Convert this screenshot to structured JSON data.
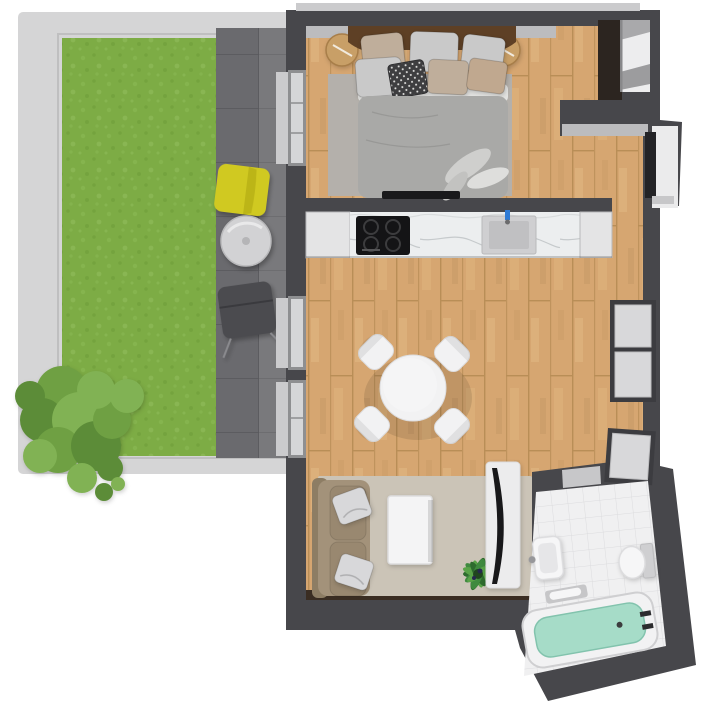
{
  "canvas": {
    "width": 716,
    "height": 720
  },
  "scene_type": "apartment-3d-floor-plan-top-view",
  "legend": {
    "outdoor": [
      "terrace-frame",
      "lawn",
      "patio-tiles",
      "bush",
      "yellow-lounge-chair",
      "patio-table",
      "dark-patio-chair"
    ],
    "bedroom": [
      "double-bed",
      "headboard",
      "pillows",
      "nightstand-left",
      "nightstand-right",
      "bedroom-rug",
      "wall-tv-bar"
    ],
    "kitchen": [
      "kitchen-counter",
      "cooktop",
      "kitchen-sink",
      "cabinet-left",
      "cabinet-right"
    ],
    "living_room": [
      "dining-table",
      "dining-chairs",
      "sofa",
      "sofa-pillows",
      "coffee-table",
      "living-rug",
      "tv-stand",
      "tv-screen",
      "floor-plant",
      "wall-windows"
    ],
    "bathroom": [
      "bathtub",
      "towel",
      "toilet",
      "bathroom-sink",
      "tiled-floor"
    ],
    "circulation": [
      "entrance-door",
      "hallway",
      "closet-niche",
      "wardrobe",
      "terrace-glass-doors"
    ]
  },
  "palette": {
    "bg": "#ffffff",
    "terrace_frame": "#d5d5d6",
    "terrace_frame_line": "#bfbfc0",
    "grass_base": "#7dac45",
    "grass_light": "#8cba55",
    "grass_light2": "#97c463",
    "grass_dark": "#6c9a37",
    "patio_base": "#6a6a6e",
    "patio_line": "#58585c",
    "wall": "#47474b",
    "wall_sill": "#bcbcbe",
    "exterior_sill": "#cbcbcd",
    "wood_base": "#d6a671",
    "wood_line": "#b98e57",
    "wood_hi": "#edc793",
    "wood_sh": "#a97f4b",
    "marble_base": "#eceeef",
    "marble_vein": "#c6cacc",
    "cabinet": "#e4e4e5",
    "cabinet_shade": "#b9b9bb",
    "cooktop": "#141416",
    "burner_ring": "#3c3c3e",
    "sink_outer": "#cfcfd1",
    "sink_basin": "#c0c0c2",
    "faucet_blue": "#2f7bd6",
    "tile_base": "#f0f0f1",
    "tile_line": "#dcdcde",
    "rug_bedroom": "#b4b0ab",
    "rug_living": "#cbc4b7",
    "duvet": "#a9a9a7",
    "sheet": "#e3e3e1",
    "crease": "#8f8f8d",
    "headboard": "#5e4025",
    "nightstand": "#c89f67",
    "nightstand_stroke": "#a87e49",
    "pillow_beige": "#bfae9b",
    "pillow_gray": "#c9c9c9",
    "pillow_tan": "#c0a88f",
    "pillow_dark": "#3e3e40",
    "sofa_back": "#8d7d64",
    "sofa_base": "#a3927a",
    "sofa_cushion": "#998870",
    "pillow_white": "#d8d8da",
    "coffee_table": "#f4f4f5",
    "table_stroke": "#dddddf",
    "dining_white": "#f2f2f3",
    "plant_dark": "#2e6b2e",
    "plant_mid": "#3f8a3f",
    "plant_light": "#59a348",
    "plant_berry": "#26284f",
    "tv_screen": "#18181a",
    "tv_stand": "#ececed",
    "door_leaf": "#232326",
    "door_frame_white": "#ebebec",
    "wardrobe_dark": "#2c2520",
    "closet_inner": "#ededee",
    "closet_shelf": "#a9a9ab",
    "closet_shelf2": "#9c9c9e",
    "window_frame": "#3c3c40",
    "window_pane": "#d8d8da",
    "glass_frame": "#8e8f91",
    "glass_pane": "#d5d6d8",
    "bar_dark": "#19191b",
    "brown_strip": "#3a2d22",
    "tub_rim": "#f2f2f3",
    "tub_stroke": "#cfcfd1",
    "tub_inner": "#a6dcc8",
    "tub_inner_edge": "#82c3ad",
    "toilet_tank": "#cfcfd1",
    "fixture_white": "#f6f6f7",
    "threshold": "#c7c7c9",
    "towel_gray": "#c6c6c8",
    "metal_gray": "#97979a",
    "chair_yellow": "#d0c921",
    "chair_yellow_fold": "#b6b015",
    "patio_table": "#d2d2d4",
    "patio_table_stroke": "#b9b9bb",
    "patio_chair_dark": "#4b4b4f",
    "bush1": "#6fa043",
    "bush2": "#81b254",
    "bush3": "#5c8c38"
  }
}
